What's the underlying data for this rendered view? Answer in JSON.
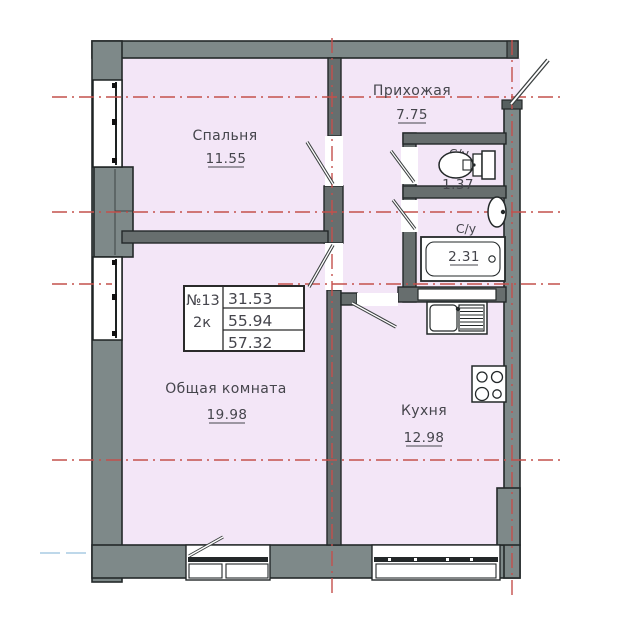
{
  "plan": {
    "title": "apartment-floor-plan",
    "rooms": {
      "bedroom": {
        "name": "Спальня",
        "area": "11.55"
      },
      "hall": {
        "name": "Прихожая",
        "area": "7.75"
      },
      "wc1": {
        "name": "С/у",
        "area": "1.37"
      },
      "wc2": {
        "name": "С/у",
        "area": "2.31"
      },
      "living": {
        "name": "Общая комната",
        "area": "19.98"
      },
      "kitchen": {
        "name": "Кухня",
        "area": "12.98"
      }
    },
    "info_box": {
      "unit_number": "№13",
      "unit_type": "2к",
      "area_living": "31.53",
      "area_heated": "55.94",
      "area_total": "57.32"
    }
  },
  "colors": {
    "room_fill": "#f3e6f7",
    "exterior_wall": "#7e8989",
    "interior_wall": "#676e6e",
    "axis_red": "#c4504c",
    "total_red": "#cc4f4f",
    "axis_blue": "#a9cce3"
  }
}
